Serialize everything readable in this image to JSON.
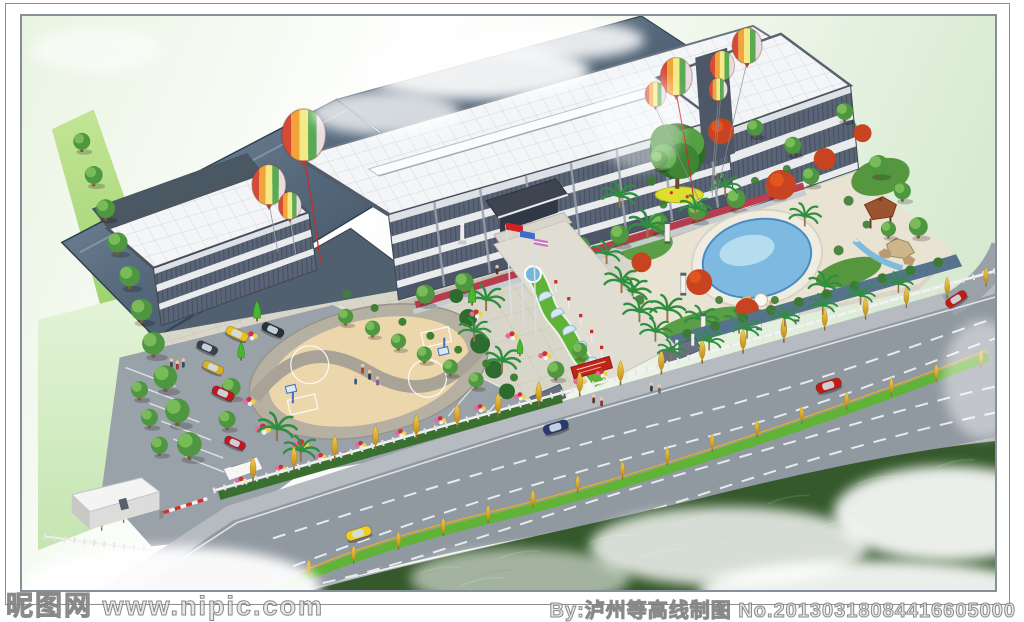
{
  "watermarks": {
    "left": "昵图网 www.nipic.com",
    "right": "By:泸州等高线制图 No.20130318084416605000"
  },
  "palette": {
    "sky_green": "#e6f2e0",
    "roof_steel_dark": "#4e5f70",
    "roof_white": "#f3f5f7",
    "facade_band_dark": "#5a6477",
    "facade_band_light": "#e9ebec",
    "tree_green": "#4e9640",
    "tree_red": "#c8431f",
    "tree_yellow": "#e3b42e",
    "pool_blue": "#7db9e0",
    "court_tan": "#ecd6ab",
    "plaza_paving": "#d8d5c9",
    "road_gray": "#9098a0",
    "median_green": "#5fb336",
    "grass_dark": "#35582c",
    "flower_pink": "#e868a0",
    "flower_red": "#d03038"
  }
}
